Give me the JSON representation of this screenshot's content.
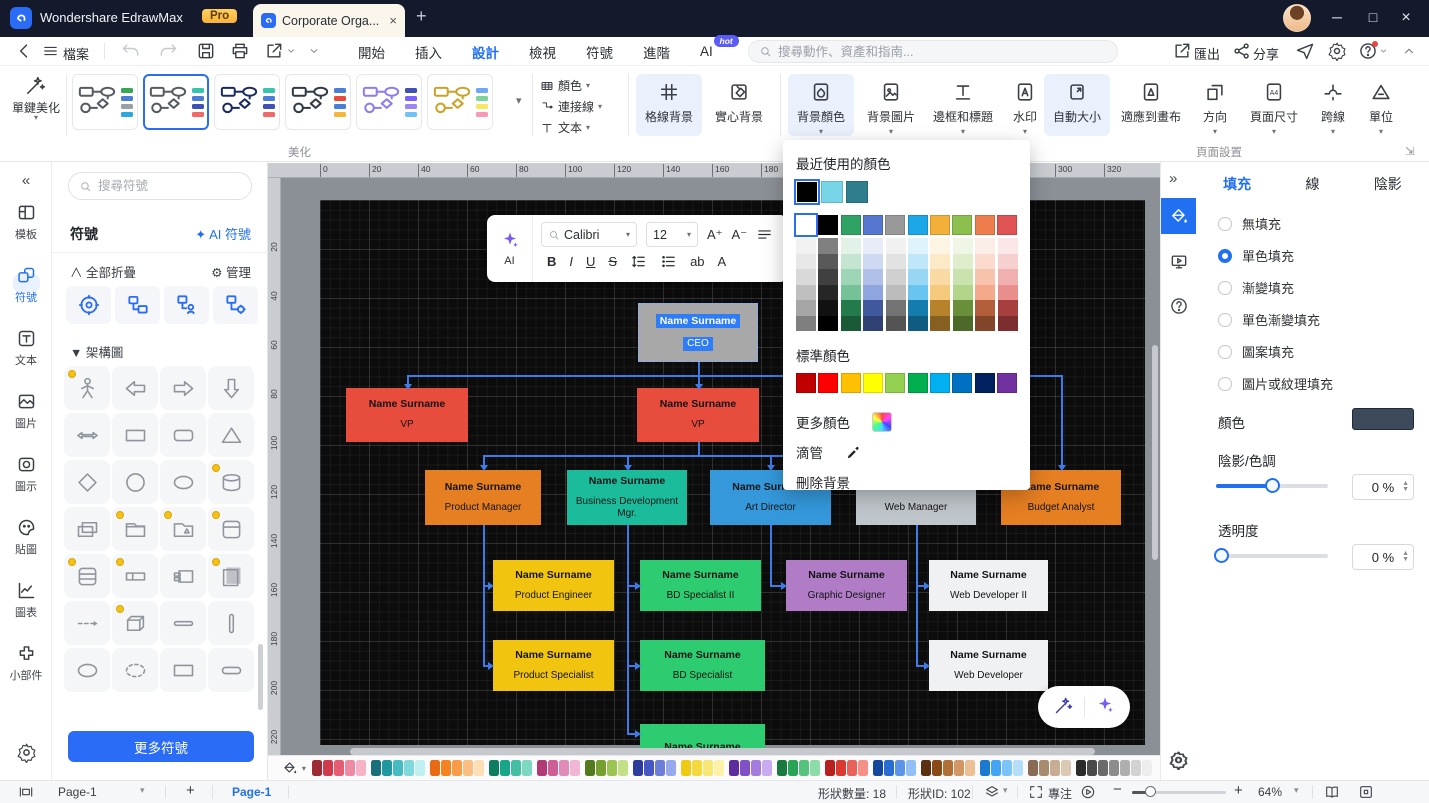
{
  "window": {
    "app_title": "Wondershare EdrawMax",
    "pro_badge": "Pro",
    "doc_tab_title": "Corporate Orga...",
    "tab_close": "×",
    "new_tab": "+",
    "minimize": "─",
    "maximize": "□",
    "close": "×"
  },
  "toolbar": {
    "file_menu": "檔案",
    "tabs": [
      "開始",
      "插入",
      "設計",
      "檢視",
      "符號",
      "進階",
      "AI"
    ],
    "active_tab": "設計",
    "hot_badge": "hot",
    "search_placeholder": "搜尋動作、資產和指南...",
    "export_label": "匯出",
    "share_label": "分享"
  },
  "ribbon": {
    "one_click_beautify": "單鍵美化",
    "beautify_group": "美化",
    "color_menu": "顏色",
    "connector_menu": "連接線",
    "text_menu": "文本",
    "grid_background": "格線背景",
    "solid_background": "實心背景",
    "background_color": "背景顏色",
    "background_image": "背景圖片",
    "border_and_title": "邊框和標題",
    "watermark": "水印",
    "auto_size": "自動大小",
    "fit_to_canvas": "適應到畫布",
    "orientation": "方向",
    "page_size": "頁面尺寸",
    "cross_line": "跨線",
    "unit": "單位",
    "page_setup_group": "頁面設置",
    "themes": [
      {
        "shape": "#555B63",
        "chips": [
          "#34A853",
          "#4A7DD6",
          "#9AA0A6",
          "#2BA8E0"
        ],
        "selected": false
      },
      {
        "shape": "#555B63",
        "chips": [
          "#35C4AE",
          "#4A7DD6",
          "#3F51B5",
          "#F06A6A"
        ],
        "selected": true
      },
      {
        "shape": "#1B2A5E",
        "chips": [
          "#35C4AE",
          "#4A7DD6",
          "#3F51B5",
          "#F06A6A"
        ],
        "selected": false
      },
      {
        "shape": "#2F3A46",
        "chips": [
          "#4A7DD6",
          "#EA4A3B",
          "#4A7DD6",
          "#F5B63C"
        ],
        "selected": false
      },
      {
        "shape": "#8F7BEF",
        "chips": [
          "#3F51B5",
          "#7B61FF",
          "#9B86F2",
          "#6FC3F7"
        ],
        "selected": false
      },
      {
        "shape": "#C9A227",
        "chips": [
          "#6FA8F5",
          "#7ED39A",
          "#F5E663",
          "#F79AB5"
        ],
        "selected": false
      }
    ]
  },
  "left_sidebar": {
    "collapse": "«",
    "items": [
      {
        "label": "模板",
        "icon": "template-icon",
        "active": false
      },
      {
        "label": "符號",
        "icon": "shapes-icon",
        "active": true
      },
      {
        "label": "文本",
        "icon": "text-panel-icon",
        "active": false
      },
      {
        "label": "圖片",
        "icon": "image-icon",
        "active": false
      },
      {
        "label": "圖示",
        "icon": "icon-frame-icon",
        "active": false
      },
      {
        "label": "貼圖",
        "icon": "sticker-icon",
        "active": false
      },
      {
        "label": "圖表",
        "icon": "chart-icon",
        "active": false
      },
      {
        "label": "小部件",
        "icon": "widget-icon",
        "active": false
      }
    ]
  },
  "symbols_panel": {
    "search_placeholder": "搜尋符號",
    "title": "符號",
    "ai_link": "AI 符號",
    "collapse_all": "全部折疊",
    "manage": "管理",
    "section": "架構圖",
    "more_symbols": "更多符號",
    "shapes": [
      "stick-figure",
      "arrow-left",
      "arrow-right",
      "arrow-down",
      "arrow-double",
      "rectangle",
      "rounded-rect",
      "triangle",
      "diamond",
      "circle",
      "ellipse",
      "cylinder",
      "class-box",
      "folder",
      "folder-flag",
      "card-top",
      "rows-box",
      "field-box",
      "component",
      "book",
      "dashed-arrow",
      "box-3d",
      "h-bar",
      "v-bar",
      "ellipse",
      "dashed-ellipse",
      "rectangle",
      "slim-rounded"
    ],
    "marked_shapes": [
      0,
      11,
      13,
      14,
      15,
      16,
      17,
      19,
      21
    ]
  },
  "floating_toolbar": {
    "ai_label": "AI",
    "font_family": "Calibri",
    "font_size": "12",
    "font_increase": "A⁺",
    "font_decrease": "A⁻",
    "bold": "B",
    "italic": "I",
    "underline": "U",
    "strike": "S",
    "highlight": "ab",
    "font_color": "A"
  },
  "color_popup": {
    "recent_label": "最近使用的顏色",
    "recent_colors": [
      "#000000",
      "#76D6E8",
      "#2F7E8C"
    ],
    "theme_base_colors": [
      "#FFFFFF",
      "#000000",
      "#2FA363",
      "#5577D0",
      "#999999",
      "#1CA7E8",
      "#F2AF3A",
      "#8CBF4D",
      "#ED7D4D",
      "#DF5452"
    ],
    "standard_label": "標準顏色",
    "standard_colors": [
      "#C00000",
      "#FE0000",
      "#FFC000",
      "#FFFF00",
      "#92D050",
      "#00B050",
      "#00B0F0",
      "#0070C0",
      "#002060",
      "#7030A0"
    ],
    "more_colors": "更多顏色",
    "eyedropper": "滴管",
    "remove_background": "刪除背景"
  },
  "canvas": {
    "page_color": "#0C0C0C",
    "connector_color": "#3E7BE8",
    "h_ruler_ticks": [
      0,
      20,
      40,
      60,
      80,
      100,
      120,
      140,
      160,
      180,
      200,
      220,
      240,
      260,
      280,
      300,
      320
    ],
    "v_ruler_ticks": [
      20,
      40,
      60,
      80,
      100,
      120,
      140,
      160,
      180,
      200,
      220
    ]
  },
  "org_chart": {
    "nodes": [
      {
        "name": "Name Surname",
        "title": "CEO",
        "x": 318,
        "y": 103,
        "w": 120,
        "h": 59,
        "bg": "#A8A8A8",
        "selected": true
      },
      {
        "name": "Name Surname",
        "title": "VP",
        "x": 26,
        "y": 188,
        "w": 122,
        "h": 54,
        "bg": "#E74C3C",
        "selected": false
      },
      {
        "name": "Name Surname",
        "title": "VP",
        "x": 317,
        "y": 188,
        "w": 122,
        "h": 54,
        "bg": "#E74C3C",
        "selected": false
      },
      {
        "name": "Name Surname",
        "title": "Product Manager",
        "x": 105,
        "y": 270,
        "w": 116,
        "h": 55,
        "bg": "#E67E22",
        "selected": false
      },
      {
        "name": "Name Surname",
        "title": "Business Development Mgr.",
        "x": 247,
        "y": 270,
        "w": 120,
        "h": 55,
        "bg": "#1ABC9C",
        "selected": false
      },
      {
        "name": "Name Surname",
        "title": "Art Director",
        "x": 390,
        "y": 270,
        "w": 121,
        "h": 55,
        "bg": "#3498DB",
        "selected": false
      },
      {
        "name": "Name Surname",
        "title": "Web Manager",
        "x": 536,
        "y": 270,
        "w": 120,
        "h": 55,
        "bg": "#BFC6CB",
        "selected": false
      },
      {
        "name": "Name Surname",
        "title": "Budget Analyst",
        "x": 681,
        "y": 270,
        "w": 120,
        "h": 55,
        "bg": "#E67E22",
        "selected": false
      },
      {
        "name": "Name Surname",
        "title": "Product Engineer",
        "x": 173,
        "y": 360,
        "w": 121,
        "h": 51,
        "bg": "#F1C40F",
        "selected": false
      },
      {
        "name": "Name Surname",
        "title": "BD Specialist II",
        "x": 320,
        "y": 360,
        "w": 121,
        "h": 51,
        "bg": "#2ECC71",
        "selected": false
      },
      {
        "name": "Name Surname",
        "title": "Graphic Designer",
        "x": 466,
        "y": 360,
        "w": 121,
        "h": 51,
        "bg": "#B07CC6",
        "selected": false
      },
      {
        "name": "Name Surname",
        "title": "Web Developer II",
        "x": 609,
        "y": 360,
        "w": 119,
        "h": 51,
        "bg": "#EFF1F2",
        "selected": false
      },
      {
        "name": "Name Surname",
        "title": "Product Specialist",
        "x": 173,
        "y": 440,
        "w": 121,
        "h": 51,
        "bg": "#F1C40F",
        "selected": false
      },
      {
        "name": "Name Surname",
        "title": "BD Specialist",
        "x": 320,
        "y": 440,
        "w": 125,
        "h": 51,
        "bg": "#2ECC71",
        "selected": false
      },
      {
        "name": "Name Surname",
        "title": "Web Developer",
        "x": 609,
        "y": 440,
        "w": 119,
        "h": 51,
        "bg": "#EFF1F2",
        "selected": false
      },
      {
        "name": "Name Surname",
        "title": "",
        "x": 320,
        "y": 524,
        "w": 125,
        "h": 45,
        "bg": "#2ECC71",
        "selected": false
      }
    ],
    "h_lines": [
      [
        175,
        87,
        741
      ],
      [
        255,
        163,
        596
      ],
      [
        385,
        163,
        170
      ],
      [
        465,
        163,
        170
      ],
      [
        385,
        307,
        317
      ],
      [
        465,
        307,
        317
      ],
      [
        533,
        307,
        317
      ],
      [
        385,
        450,
        463
      ],
      [
        385,
        596,
        606
      ],
      [
        465,
        596,
        606
      ]
    ],
    "v_lines": [
      [
        378,
        162,
        176
      ],
      [
        87,
        175,
        186
      ],
      [
        378,
        175,
        186
      ],
      [
        741,
        175,
        267
      ],
      [
        378,
        242,
        256
      ],
      [
        163,
        255,
        267
      ],
      [
        307,
        255,
        267
      ],
      [
        450,
        255,
        267
      ],
      [
        596,
        255,
        267
      ],
      [
        163,
        325,
        466
      ],
      [
        307,
        325,
        534
      ],
      [
        450,
        325,
        386
      ],
      [
        596,
        325,
        466
      ]
    ],
    "arrows_down": [
      [
        87,
        184
      ],
      [
        378,
        184
      ],
      [
        741,
        265
      ],
      [
        163,
        265
      ],
      [
        307,
        265
      ],
      [
        450,
        265
      ],
      [
        596,
        265
      ]
    ],
    "arrows_right": [
      [
        168,
        385
      ],
      [
        168,
        465
      ],
      [
        315,
        385
      ],
      [
        315,
        465
      ],
      [
        315,
        533
      ],
      [
        461,
        385
      ],
      [
        604,
        385
      ],
      [
        604,
        465
      ]
    ]
  },
  "right_panel": {
    "tabs": [
      "填充",
      "線",
      "陰影"
    ],
    "active_tab": "填充",
    "fill_options": [
      "無填充",
      "單色填充",
      "漸變填充",
      "單色漸變填充",
      "圖案填充",
      "圖片或紋理填充"
    ],
    "selected_option": "單色填充",
    "color_label": "顏色",
    "color_value": "#3D4A5A",
    "shade_label": "陰影/色調",
    "shade_value": "0 %",
    "shade_percent": 50,
    "opacity_label": "透明度",
    "opacity_value": "0 %",
    "opacity_percent": 0
  },
  "bottom_palette": {
    "groups": [
      [
        "#9E2A35",
        "#D03A4B",
        "#E55D72",
        "#EF8AA4",
        "#F6B3C8"
      ],
      [
        "#18707A",
        "#1F98A0",
        "#44BCC2",
        "#7FD8DC",
        "#BEEFF1"
      ],
      [
        "#E86A12",
        "#F5831F",
        "#F89C4A",
        "#FBBD80",
        "#FDDEB5"
      ],
      [
        "#0E7C60",
        "#17A689",
        "#43BFA3",
        "#7ED7C0"
      ],
      [
        "#B03A76",
        "#CE5F96",
        "#E28AB8",
        "#F0B6D4"
      ],
      [
        "#55791E",
        "#76A02F",
        "#9CC452",
        "#C4E086"
      ],
      [
        "#2E3C9E",
        "#4656C2",
        "#6C7EDA",
        "#98A8EC"
      ],
      [
        "#EECB12",
        "#F3D93F",
        "#F8E773",
        "#FBF2A8"
      ],
      [
        "#5D2C9E",
        "#8150C6",
        "#A57BDF",
        "#C9ABEF"
      ],
      [
        "#19793E",
        "#29A356",
        "#54C37D",
        "#8CDCAA"
      ],
      [
        "#B7201F",
        "#DA3B30",
        "#EA6159",
        "#F59088"
      ],
      [
        "#14489F",
        "#2B6CD3",
        "#5C95E8",
        "#92BFF5"
      ],
      [
        "#5C2F0F",
        "#8A4A18",
        "#B06F35",
        "#D29764",
        "#ECBF95"
      ],
      [
        "#1C79D0",
        "#42A5F5",
        "#7CC3F8",
        "#B3DEFA"
      ],
      [
        "#8A6A52",
        "#A98B70",
        "#C6AD94",
        "#DCC9B4"
      ],
      [
        "#2A2A2A",
        "#4A4A4A",
        "#6A6A6A",
        "#8C8C8C",
        "#AFAFAF",
        "#D2D2D2",
        "#EDEDED",
        "#FAFAFA"
      ]
    ]
  },
  "status_bar": {
    "page_selector": "Page-1",
    "page_tab": "Page-1",
    "shape_count": "形狀數量: 18",
    "shape_id": "形狀ID: 102",
    "focus": "專注",
    "zoom": "64%"
  }
}
